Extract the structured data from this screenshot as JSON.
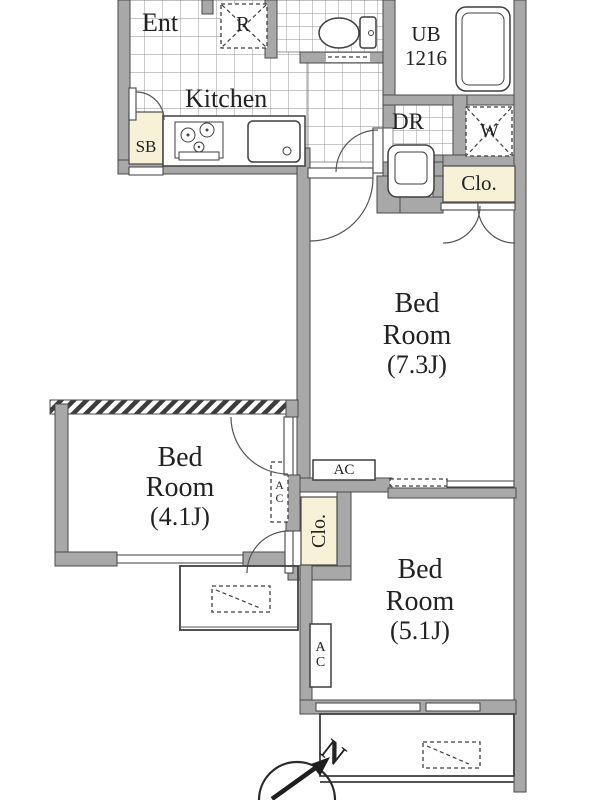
{
  "plan": {
    "type": "apartment-floor-plan",
    "labels": {
      "entrance": "Ent",
      "refrigerator": "R",
      "kitchen": "Kitchen",
      "shoe_box": "SB",
      "unit_bath": {
        "line1": "UB",
        "line2": "1216"
      },
      "dressing_room": "DR",
      "washer": "W",
      "closet_hall": "Clo.",
      "closet_middle": "Clo.",
      "ac_bedroom1": "AC",
      "ac_bedroom2": "AC",
      "ac_bedroom3": "AC",
      "compass_north": "N",
      "bedroom1": {
        "line1": "Bed",
        "line2": "Room",
        "size": "(7.3J)"
      },
      "bedroom2": {
        "line1": "Bed",
        "line2": "Room",
        "size": "(4.1J)"
      },
      "bedroom3": {
        "line1": "Bed",
        "line2": "Room",
        "size": "(5.1J)"
      }
    },
    "colors": {
      "wall_fill": "#a8a8a8",
      "wall_stroke": "#4a4a4a",
      "closet_fill": "#f6f1d7",
      "line": "#3f3f3f",
      "text": "#222222",
      "background": "#ffffff"
    }
  }
}
